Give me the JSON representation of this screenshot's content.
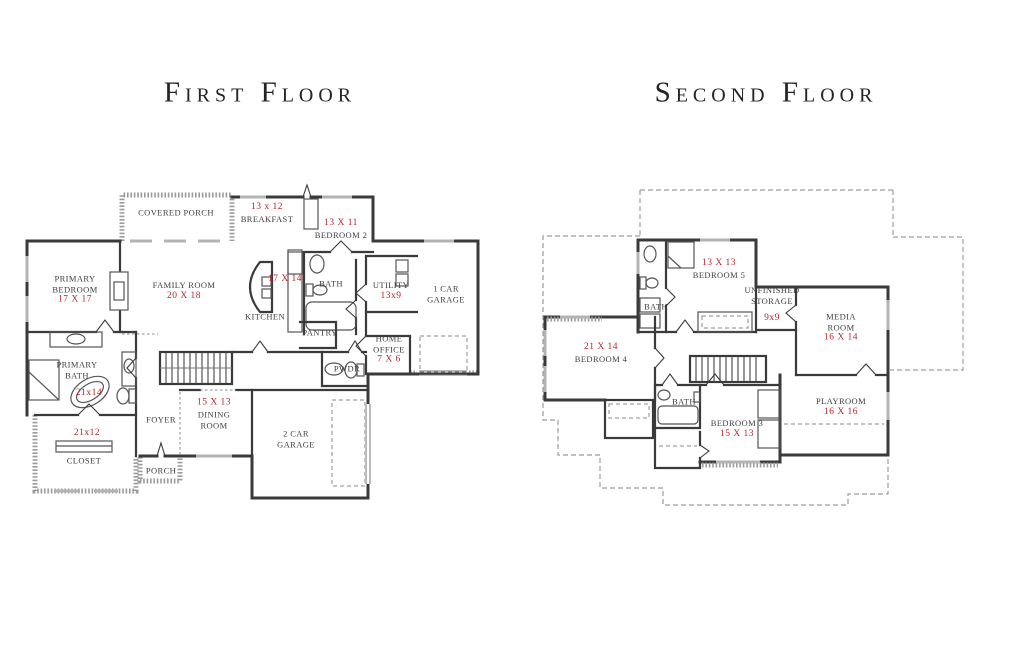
{
  "colors": {
    "wall": "#3a3a3a",
    "dimension_red": "#b4272c",
    "room_text": "#3d3d3d",
    "roof_dash": "#9e9e9e"
  },
  "titles": {
    "first": "First Floor",
    "second": "Second Floor"
  },
  "first_floor": {
    "covered_porch": {
      "name": "COVERED PORCH"
    },
    "breakfast": {
      "dim": "13 x 12",
      "name": "BREAKFAST"
    },
    "bedroom2": {
      "dim": "13 X 11",
      "name": "BEDROOM 2"
    },
    "primary_bedroom": {
      "name": "PRIMARY BEDROOM",
      "dim": "17 X 17"
    },
    "family_room": {
      "name": "FAMILY ROOM",
      "dim": "20 X 18"
    },
    "kitchen": {
      "name": "KITCHEN",
      "dim": "17 X 14"
    },
    "bath": {
      "name": "BATH"
    },
    "utility": {
      "name": "UTILITY",
      "dim": "13x9"
    },
    "one_car_garage": {
      "name": "1 CAR GARAGE"
    },
    "pantry": {
      "name": "PANTRY"
    },
    "home_office": {
      "name": "HOME OFFICE",
      "dim": "7 X 6"
    },
    "powder": {
      "name": "PWDR"
    },
    "primary_bath": {
      "name": "PRIMARY BATH",
      "dim": "21x14"
    },
    "foyer": {
      "name": "FOYER"
    },
    "dining_room": {
      "dim": "15 X 13",
      "name": "DINING ROOM"
    },
    "closet": {
      "dim": "21x12",
      "name": "CLOSET"
    },
    "two_car_garage": {
      "name": "2 CAR GARAGE"
    },
    "porch": {
      "name": "PORCH"
    }
  },
  "second_floor": {
    "bath_upper": {
      "name": "BATH"
    },
    "bedroom5": {
      "dim": "13 X 13",
      "name": "BEDROOM 5"
    },
    "unfinished_storage": {
      "name": "UNFINISHED STORAGE",
      "dim": "9x9"
    },
    "media_room": {
      "name": "MEDIA ROOM",
      "dim": "16 X 14"
    },
    "bedroom4": {
      "dim": "21 X 14",
      "name": "BEDROOM 4"
    },
    "bath_lower": {
      "name": "BATH"
    },
    "bedroom3": {
      "name": "BEDROOM 3",
      "dim": "15 X 13"
    },
    "playroom": {
      "name": "PLAYROOM",
      "dim": "16 X 16"
    }
  }
}
